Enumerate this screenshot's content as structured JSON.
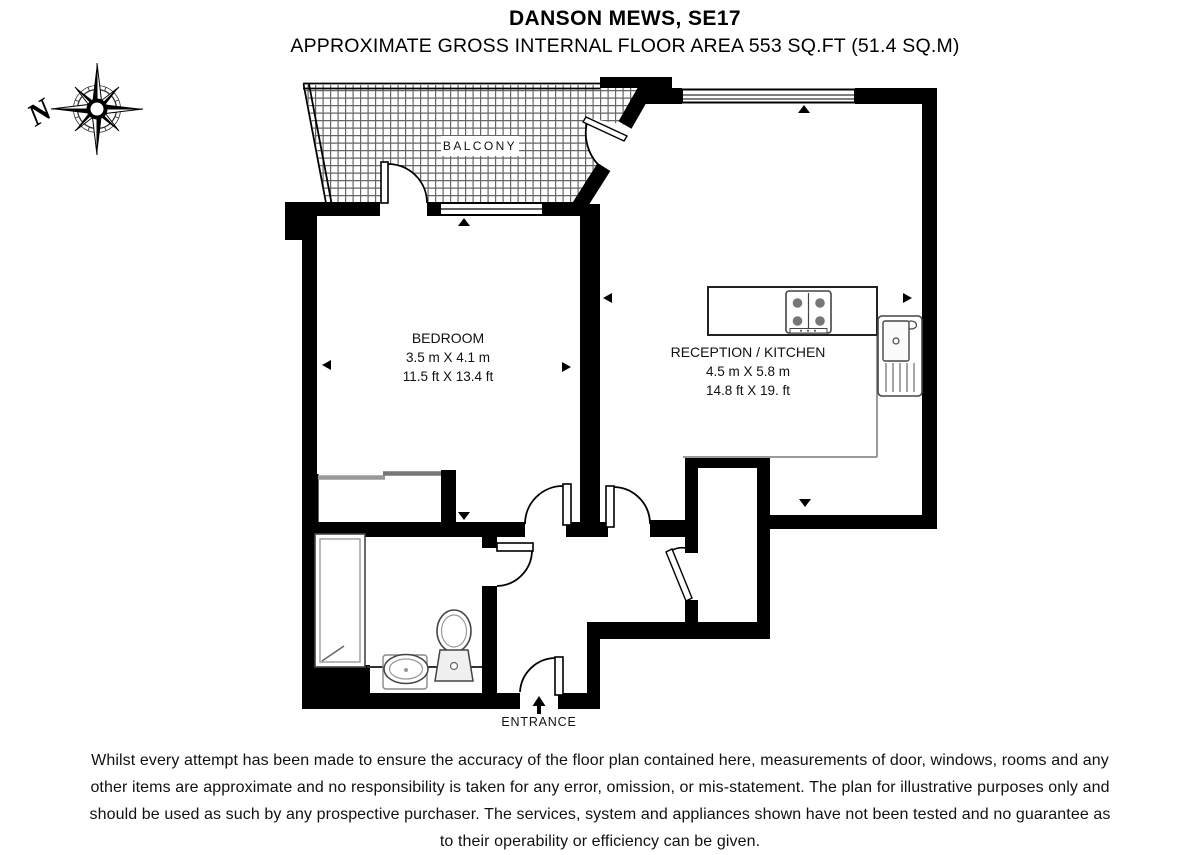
{
  "header": {
    "title": "DANSON MEWS, SE17",
    "subtitle": "APPROXIMATE GROSS INTERNAL FLOOR AREA 553 SQ.FT (51.4 SQ.M)"
  },
  "compass": {
    "north_label": "N"
  },
  "rooms": {
    "balcony": {
      "label": "BALCONY"
    },
    "bedroom": {
      "label": "BEDROOM",
      "size_metric": "3.5 m X 4.1 m",
      "size_imperial": "11.5 ft X 13.4 ft"
    },
    "reception": {
      "label": "RECEPTION / KITCHEN",
      "size_metric": "4.5 m X 5.8 m",
      "size_imperial": "14.8 ft X 19. ft"
    }
  },
  "entrance": {
    "label": "ENTRANCE"
  },
  "disclaimer": {
    "line1": "Whilst every attempt has been made to ensure the accuracy of the floor plan contained here, measurements of door, windows, rooms and any",
    "line2": "other items are approximate and no responsibility is taken for any error, omission, or mis-statement. The plan for illustrative purposes only and",
    "line3": "should be used as such by any prospective purchaser. The services, system and appliances shown have not been tested and no guarantee as",
    "line4": "to their operability or efficiency can be given."
  },
  "colors": {
    "wall": "#000000",
    "fixture_outline": "#555555",
    "hatch_line": "#666666",
    "text": "#000000"
  }
}
